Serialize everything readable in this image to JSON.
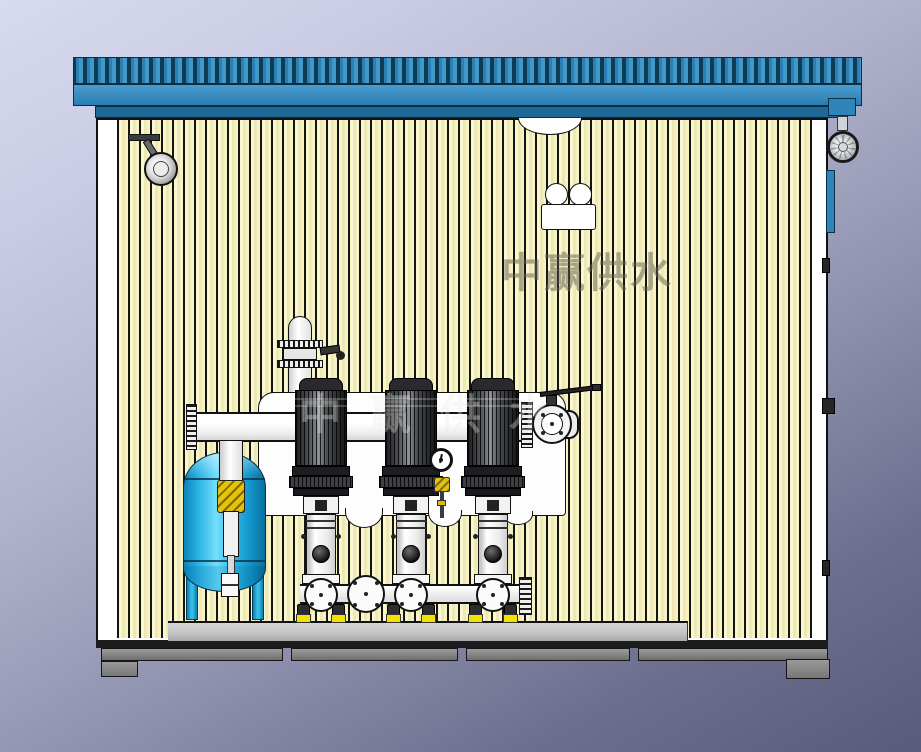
{
  "scene": {
    "kind": "3d-cad-render",
    "subject": "packaged booster pump set inside corrugated enclosure (cutaway side view)",
    "pump_count": 3
  },
  "watermark": {
    "text": "中赢供水"
  },
  "colors": {
    "background_top": "#d8daee",
    "background_bottom": "#585b7a",
    "roof_blue": "#3488bc",
    "roof_band_dark": "#1d6896",
    "wall_cream": "#f9f6cc",
    "wall_stripe_dark": "#15150f",
    "tank_cyan": "#2db4e6",
    "pipe_white": "#fdfdfd",
    "motor_dark": "#2a2a2e",
    "vibration_pad_yellow": "#f3e200",
    "brass_valve_yellow": "#e3c30c",
    "platform_gray": "#c2c2c2",
    "base_frame_gray": "#7d7d7d",
    "side_panel_blue": "#2f85b9"
  },
  "components": {
    "roof": "corrugated-blue-roof",
    "wall": "striped-panel-wall",
    "lighting": [
      "ceiling-spotlight",
      "dome-light",
      "emergency-light"
    ],
    "exterior": [
      "exhaust-fan",
      "side-panel",
      "door-hinges"
    ],
    "equipment": [
      "pressure-tank",
      "tank-riser-pipe",
      "inlet-valve",
      "discharge-manifold",
      "outlet-butterfly-valve",
      "pump-units",
      "suction-manifold",
      "pressure-gauge",
      "skid-platform",
      "base-frame"
    ]
  }
}
